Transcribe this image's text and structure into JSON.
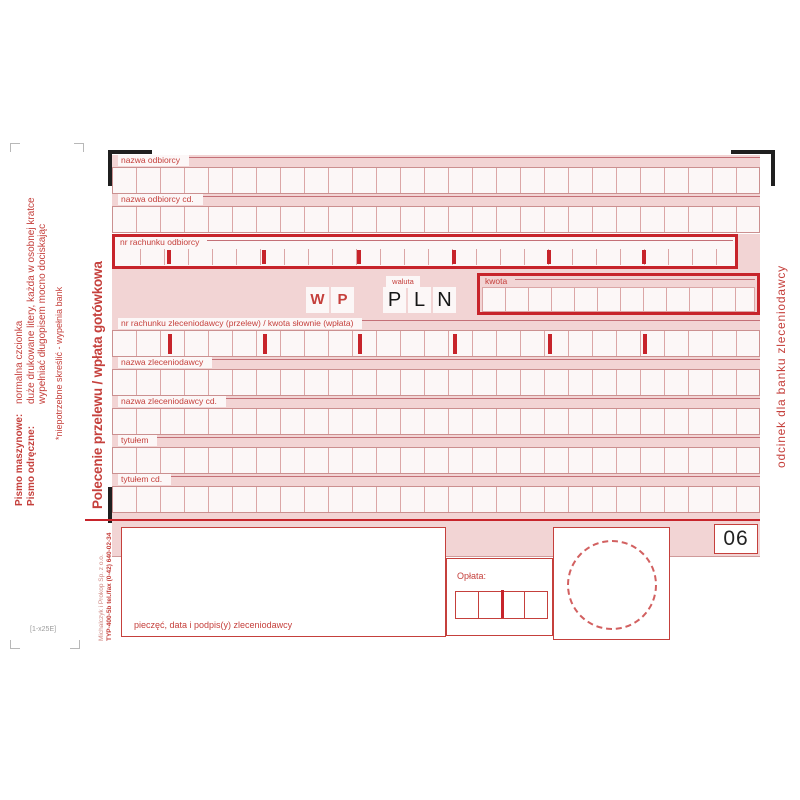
{
  "title": "Polecenie przelewu / wpłata gotówkowa",
  "right_strip": "odcinek dla banku zleceniodawcy",
  "instructions": {
    "rows": [
      {
        "label": "Pismo maszynowe:",
        "text": "normalna czcionka"
      },
      {
        "label": "Pismo odręczne:",
        "text": "duże drukowane litery, każda w osobnej kratce"
      },
      {
        "label": "",
        "text": "wypełniać długopisem mocno dociskając"
      }
    ],
    "note": "*niepotrzebne skreślić - wypełnia bank"
  },
  "printer": {
    "line1": "Michalczyk i Prokop Sp. z o.o.",
    "line2": "TYP-400-5b  tel./fax (0-42) 640-02-34",
    "code": "[1-x25E]"
  },
  "form": {
    "cells_per_row": 27,
    "rows": [
      {
        "name": "recipient-name",
        "label": "nazwa odbiorcy",
        "type": "plain"
      },
      {
        "name": "recipient-name-cont",
        "label": "nazwa odbiorcy cd.",
        "type": "plain"
      },
      {
        "name": "recipient-account-number",
        "label": "nr rachunku odbiorcy",
        "type": "thick"
      },
      {
        "name": "amount",
        "label": "",
        "type": "amount"
      },
      {
        "name": "payer-account-or-amount-in-words",
        "label": "nr rachunku zleceniodawcy (przelew) / kwota słownie (wpłata)",
        "type": "ticked"
      },
      {
        "name": "payer-name",
        "label": "nazwa zleceniodawcy",
        "type": "plain"
      },
      {
        "name": "payer-name-cont",
        "label": "nazwa zleceniodawcy cd.",
        "type": "plain"
      },
      {
        "name": "transfer-title",
        "label": "tytułem",
        "type": "plain"
      },
      {
        "name": "transfer-title-cont",
        "label": "tytułem cd.",
        "type": "plain"
      }
    ],
    "amount": {
      "wp": [
        "W",
        "P"
      ],
      "waluta_label": "waluta",
      "currency_letters": [
        "P",
        "L",
        "N"
      ],
      "kwota_label": "kwota",
      "kwota_cells": 12
    }
  },
  "footer": {
    "segment_number": "06",
    "fee_label": "Opłata:",
    "fee_cells": 4,
    "stamp_box_label": "pieczęć, data i podpis(y) zleceniodawcy"
  },
  "colors": {
    "band_pink": "#f2d4d4",
    "cell_bg": "#fcf7f7",
    "line_red": "#c47077",
    "label_red": "#c5403c",
    "thick_red": "#c7242b",
    "black": "#1f1f1f"
  }
}
